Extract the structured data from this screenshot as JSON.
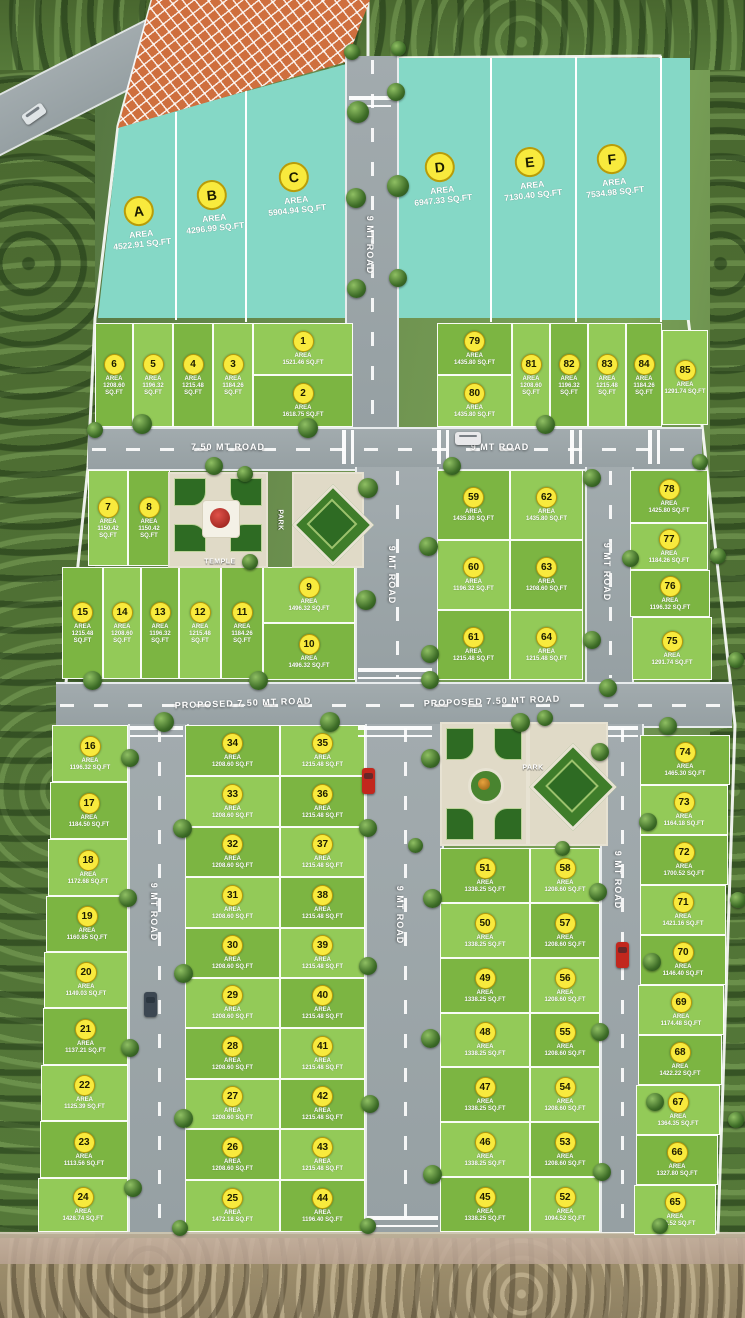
{
  "site": {
    "name": "residential-plot-layout",
    "colors": {
      "teal_plot": "#85d8c6",
      "plot_green_dark": "#7cb542",
      "plot_green_light": "#93ca58",
      "road_gray": "#9aa4a7",
      "marker_yellow": "#f8ea3d",
      "hatch_orange": "#cf6f3e",
      "boundary_white": "#ffffff"
    }
  },
  "teal_plots": [
    {
      "id": "A",
      "area_label": "AREA",
      "sqft": "4522.91 SQ.FT",
      "cx": 140,
      "cy": 212
    },
    {
      "id": "B",
      "area_label": "AREA",
      "sqft": "4296.99 SQ.FT",
      "cx": 213,
      "cy": 196
    },
    {
      "id": "C",
      "area_label": "AREA",
      "sqft": "5904.94 SQ.FT",
      "cx": 295,
      "cy": 178
    },
    {
      "id": "D",
      "area_label": "AREA",
      "sqft": "6947.33 SQ.FT",
      "cx": 441,
      "cy": 168
    },
    {
      "id": "E",
      "area_label": "AREA",
      "sqft": "7130.40 SQ.FT",
      "cx": 531,
      "cy": 163
    },
    {
      "id": "F",
      "area_label": "AREA",
      "sqft": "7534.98 SQ.FT",
      "cx": 613,
      "cy": 160
    }
  ],
  "plots": [
    [
      6,
      95,
      323,
      38,
      104,
      0,
      "1208.60 SQ.FT"
    ],
    [
      5,
      133,
      323,
      40,
      104,
      1,
      "1196.32 SQ.FT"
    ],
    [
      4,
      173,
      323,
      40,
      104,
      0,
      "1215.48 SQ.FT"
    ],
    [
      3,
      213,
      323,
      40,
      104,
      1,
      "1184.26 SQ.FT"
    ],
    [
      1,
      253,
      323,
      100,
      52,
      1,
      "1521.46 SQ.FT"
    ],
    [
      2,
      253,
      375,
      100,
      52,
      0,
      "1618.75 SQ.FT"
    ],
    [
      79,
      437,
      323,
      75,
      52,
      0,
      "1435.80 SQ.FT"
    ],
    [
      80,
      437,
      375,
      75,
      52,
      1,
      "1435.80 SQ.FT"
    ],
    [
      81,
      512,
      323,
      38,
      104,
      1,
      "1208.60 SQ.FT"
    ],
    [
      82,
      550,
      323,
      38,
      104,
      0,
      "1196.32 SQ.FT"
    ],
    [
      83,
      588,
      323,
      38,
      104,
      1,
      "1215.48 SQ.FT"
    ],
    [
      84,
      626,
      323,
      36,
      104,
      0,
      "1184.26 SQ.FT"
    ],
    [
      85,
      662,
      330,
      46,
      95,
      1,
      "1291.74 SQ.FT"
    ],
    [
      7,
      88,
      470,
      40,
      96,
      1,
      "1150.42 SQ.FT"
    ],
    [
      8,
      128,
      470,
      42,
      96,
      0,
      "1150.42 SQ.FT"
    ],
    [
      15,
      62,
      567,
      41,
      112,
      0,
      "1215.48 SQ.FT"
    ],
    [
      14,
      103,
      567,
      38,
      112,
      1,
      "1208.60 SQ.FT"
    ],
    [
      13,
      141,
      567,
      38,
      112,
      0,
      "1196.32 SQ.FT"
    ],
    [
      12,
      179,
      567,
      42,
      112,
      1,
      "1215.48 SQ.FT"
    ],
    [
      11,
      221,
      567,
      42,
      112,
      0,
      "1184.26 SQ.FT"
    ],
    [
      9,
      263,
      567,
      92,
      56,
      1,
      "1496.32 SQ.FT"
    ],
    [
      10,
      263,
      623,
      92,
      57,
      0,
      "1496.32 SQ.FT"
    ],
    [
      59,
      437,
      470,
      73,
      70,
      0,
      "1435.80 SQ.FT"
    ],
    [
      60,
      437,
      540,
      73,
      70,
      1,
      "1196.32 SQ.FT"
    ],
    [
      61,
      437,
      610,
      73,
      70,
      0,
      "1215.48 SQ.FT"
    ],
    [
      62,
      510,
      470,
      73,
      70,
      1,
      "1435.80 SQ.FT"
    ],
    [
      63,
      510,
      540,
      73,
      70,
      0,
      "1208.60 SQ.FT"
    ],
    [
      64,
      510,
      610,
      73,
      70,
      1,
      "1215.48 SQ.FT"
    ],
    [
      78,
      630,
      470,
      78,
      53,
      0,
      "1425.80 SQ.FT"
    ],
    [
      77,
      630,
      523,
      78,
      47,
      1,
      "1184.26 SQ.FT"
    ],
    [
      76,
      630,
      570,
      80,
      47,
      0,
      "1196.32 SQ.FT"
    ],
    [
      75,
      632,
      617,
      80,
      63,
      1,
      "1291.74 SQ.FT"
    ],
    [
      16,
      52,
      725,
      76,
      57,
      1,
      "1196.32 SQ.FT"
    ],
    [
      17,
      50,
      782,
      78,
      57,
      0,
      "1184.50 SQ.FT"
    ],
    [
      18,
      48,
      839,
      80,
      57,
      1,
      "1172.68 SQ.FT"
    ],
    [
      19,
      46,
      896,
      82,
      56,
      0,
      "1160.85 SQ.FT"
    ],
    [
      20,
      44,
      952,
      84,
      56,
      1,
      "1149.03 SQ.FT"
    ],
    [
      21,
      43,
      1008,
      85,
      57,
      0,
      "1137.21 SQ.FT"
    ],
    [
      22,
      41,
      1065,
      87,
      56,
      1,
      "1125.39 SQ.FT"
    ],
    [
      23,
      40,
      1121,
      88,
      57,
      0,
      "1113.56 SQ.FT"
    ],
    [
      24,
      38,
      1178,
      90,
      54,
      1,
      "1428.74 SQ.FT"
    ],
    [
      34,
      185,
      725,
      95,
      51,
      0,
      "1208.60 SQ.FT"
    ],
    [
      33,
      185,
      776,
      95,
      51,
      1,
      "1208.60 SQ.FT"
    ],
    [
      32,
      185,
      827,
      95,
      50,
      0,
      "1208.60 SQ.FT"
    ],
    [
      31,
      185,
      877,
      95,
      51,
      1,
      "1208.60 SQ.FT"
    ],
    [
      30,
      185,
      928,
      95,
      50,
      0,
      "1208.60 SQ.FT"
    ],
    [
      29,
      185,
      978,
      95,
      50,
      1,
      "1208.60 SQ.FT"
    ],
    [
      28,
      185,
      1028,
      95,
      51,
      0,
      "1208.60 SQ.FT"
    ],
    [
      27,
      185,
      1079,
      95,
      50,
      1,
      "1208.60 SQ.FT"
    ],
    [
      26,
      185,
      1129,
      95,
      51,
      0,
      "1208.60 SQ.FT"
    ],
    [
      25,
      185,
      1180,
      95,
      52,
      1,
      "1472.18 SQ.FT"
    ],
    [
      35,
      280,
      725,
      85,
      51,
      1,
      "1215.48 SQ.FT"
    ],
    [
      36,
      280,
      776,
      85,
      51,
      0,
      "1215.48 SQ.FT"
    ],
    [
      37,
      280,
      827,
      85,
      50,
      1,
      "1215.48 SQ.FT"
    ],
    [
      38,
      280,
      877,
      85,
      51,
      0,
      "1215.48 SQ.FT"
    ],
    [
      39,
      280,
      928,
      85,
      50,
      1,
      "1215.48 SQ.FT"
    ],
    [
      40,
      280,
      978,
      85,
      50,
      0,
      "1215.48 SQ.FT"
    ],
    [
      41,
      280,
      1028,
      85,
      51,
      1,
      "1215.48 SQ.FT"
    ],
    [
      42,
      280,
      1079,
      85,
      50,
      0,
      "1215.48 SQ.FT"
    ],
    [
      43,
      280,
      1129,
      85,
      51,
      1,
      "1215.48 SQ.FT"
    ],
    [
      44,
      280,
      1180,
      85,
      52,
      0,
      "1196.40 SQ.FT"
    ],
    [
      51,
      440,
      848,
      90,
      55,
      0,
      "1338.25 SQ.FT"
    ],
    [
      50,
      440,
      903,
      90,
      55,
      1,
      "1338.25 SQ.FT"
    ],
    [
      49,
      440,
      958,
      90,
      55,
      0,
      "1338.25 SQ.FT"
    ],
    [
      48,
      440,
      1013,
      90,
      54,
      1,
      "1338.25 SQ.FT"
    ],
    [
      47,
      440,
      1067,
      90,
      55,
      0,
      "1338.25 SQ.FT"
    ],
    [
      46,
      440,
      1122,
      90,
      55,
      1,
      "1338.25 SQ.FT"
    ],
    [
      45,
      440,
      1177,
      90,
      55,
      0,
      "1338.25 SQ.FT"
    ],
    [
      58,
      530,
      848,
      70,
      55,
      1,
      "1208.60 SQ.FT"
    ],
    [
      57,
      530,
      903,
      70,
      55,
      0,
      "1208.60 SQ.FT"
    ],
    [
      56,
      530,
      958,
      70,
      55,
      1,
      "1208.60 SQ.FT"
    ],
    [
      55,
      530,
      1013,
      70,
      54,
      0,
      "1208.60 SQ.FT"
    ],
    [
      54,
      530,
      1067,
      70,
      55,
      1,
      "1208.60 SQ.FT"
    ],
    [
      53,
      530,
      1122,
      70,
      55,
      0,
      "1208.60 SQ.FT"
    ],
    [
      52,
      530,
      1177,
      70,
      55,
      1,
      "1094.52 SQ.FT"
    ],
    [
      74,
      640,
      735,
      90,
      50,
      0,
      "1465.30 SQ.FT"
    ],
    [
      73,
      640,
      785,
      88,
      50,
      1,
      "1164.18 SQ.FT"
    ],
    [
      72,
      640,
      835,
      88,
      50,
      0,
      "1700.52 SQ.FT"
    ],
    [
      71,
      640,
      885,
      86,
      50,
      1,
      "1421.16 SQ.FT"
    ],
    [
      70,
      640,
      935,
      86,
      50,
      0,
      "1146.40 SQ.FT"
    ],
    [
      69,
      638,
      985,
      86,
      50,
      1,
      "1174.48 SQ.FT"
    ],
    [
      68,
      638,
      1035,
      84,
      50,
      0,
      "1422.22 SQ.FT"
    ],
    [
      67,
      636,
      1085,
      84,
      50,
      1,
      "1364.35 SQ.FT"
    ],
    [
      66,
      636,
      1135,
      82,
      50,
      0,
      "1327.80 SQ.FT"
    ],
    [
      65,
      634,
      1185,
      82,
      50,
      1,
      "1312.52 SQ.FT"
    ]
  ],
  "roads": [
    {
      "id": "top-vertical",
      "label": "9 MT ROAD",
      "dir": "v",
      "x": 345,
      "y": 56,
      "w": 50,
      "h": 371,
      "lx": 370,
      "ly": 245
    },
    {
      "id": "upper-horizontal-west",
      "label": "7.50 MT ROAD",
      "dir": "h",
      "x": 88,
      "y": 427,
      "w": 614,
      "h": 40,
      "lx": 228,
      "ly": 447
    },
    {
      "id": "upper-horizontal-east",
      "label": "9 MT ROAD",
      "dir": "h",
      "x": 0,
      "y": 0,
      "w": 0,
      "h": 0,
      "lx": 500,
      "ly": 447
    },
    {
      "id": "center-vertical-mid",
      "label": "9 MT ROAD",
      "dir": "v",
      "x": 355,
      "y": 467,
      "w": 80,
      "h": 215,
      "lx": 392,
      "ly": 575
    },
    {
      "id": "east-vertical-mid",
      "label": "9 MT ROAD",
      "dir": "v",
      "x": 585,
      "y": 467,
      "w": 45,
      "h": 215,
      "lx": 607,
      "ly": 572
    },
    {
      "id": "proposed-road",
      "label": "PROPOSED 7.50 MT ROAD",
      "dir": "h",
      "x": 56,
      "y": 682,
      "w": 676,
      "h": 42,
      "lx": 243,
      "ly": 703
    },
    {
      "id": "proposed-road-east-label",
      "label": "PROPOSED 7.50 MT ROAD",
      "dir": "h",
      "x": 0,
      "y": 0,
      "w": 0,
      "h": 0,
      "lx": 492,
      "ly": 701
    },
    {
      "id": "west-vertical-low",
      "label": "9 MT ROAD",
      "dir": "v",
      "x": 128,
      "y": 724,
      "w": 57,
      "h": 508,
      "lx": 154,
      "ly": 912
    },
    {
      "id": "center-vertical-low",
      "label": "9 MT ROAD",
      "dir": "v",
      "x": 365,
      "y": 724,
      "w": 75,
      "h": 508,
      "lx": 400,
      "ly": 915
    },
    {
      "id": "east-vertical-low",
      "label": "9 MT ROAD",
      "dir": "v",
      "x": 600,
      "y": 724,
      "w": 40,
      "h": 508,
      "lx": 618,
      "ly": 880
    }
  ],
  "crossings": [
    {
      "t": "v",
      "x": 349,
      "y": 96,
      "w": 42,
      "h": 11
    },
    {
      "t": "h",
      "x": 342,
      "y": 430,
      "w": 12,
      "h": 34
    },
    {
      "t": "h",
      "x": 437,
      "y": 430,
      "w": 12,
      "h": 34
    },
    {
      "t": "h",
      "x": 570,
      "y": 430,
      "w": 12,
      "h": 34
    },
    {
      "t": "h",
      "x": 648,
      "y": 430,
      "w": 12,
      "h": 34
    },
    {
      "t": "v",
      "x": 358,
      "y": 668,
      "w": 74,
      "h": 11
    },
    {
      "t": "v",
      "x": 358,
      "y": 726,
      "w": 74,
      "h": 11
    },
    {
      "t": "v",
      "x": 130,
      "y": 726,
      "w": 53,
      "h": 11
    },
    {
      "t": "v",
      "x": 602,
      "y": 726,
      "w": 36,
      "h": 11
    },
    {
      "t": "v",
      "x": 367,
      "y": 1216,
      "w": 71,
      "h": 11
    }
  ],
  "landmarks": {
    "temple": {
      "label": "TEMPLE",
      "x": 168,
      "y": 472,
      "w": 100,
      "h": 96
    },
    "upper_park": {
      "label": "PARK",
      "x": 292,
      "y": 472,
      "w": 72,
      "h": 96,
      "label_x": 280,
      "label_y": 520
    },
    "lower_park_square": {
      "x": 440,
      "y": 722,
      "w": 88,
      "h": 124
    },
    "lower_park_diamond": {
      "label": "PARK",
      "x": 528,
      "y": 722,
      "w": 80,
      "h": 124,
      "label_x": 533,
      "label_y": 768
    },
    "gate_structure": {
      "x": 346,
      "y": 70,
      "w": 48,
      "h": 34
    }
  },
  "trees": [
    [
      358,
      112,
      22
    ],
    [
      396,
      92,
      18
    ],
    [
      356,
      198,
      20
    ],
    [
      398,
      186,
      22
    ],
    [
      356,
      288,
      19
    ],
    [
      398,
      278,
      18
    ],
    [
      352,
      52,
      16
    ],
    [
      398,
      48,
      15
    ],
    [
      142,
      424,
      20
    ],
    [
      214,
      466,
      18
    ],
    [
      308,
      428,
      20
    ],
    [
      452,
      466,
      18
    ],
    [
      545,
      424,
      19
    ],
    [
      95,
      430,
      16
    ],
    [
      368,
      488,
      20
    ],
    [
      428,
      546,
      19
    ],
    [
      366,
      600,
      20
    ],
    [
      430,
      654,
      18
    ],
    [
      245,
      474,
      16
    ],
    [
      250,
      562,
      16
    ],
    [
      592,
      478,
      18
    ],
    [
      630,
      558,
      17
    ],
    [
      592,
      640,
      18
    ],
    [
      700,
      462,
      16
    ],
    [
      718,
      556,
      16
    ],
    [
      92,
      680,
      19
    ],
    [
      164,
      722,
      20
    ],
    [
      258,
      680,
      19
    ],
    [
      330,
      722,
      20
    ],
    [
      430,
      680,
      18
    ],
    [
      520,
      722,
      19
    ],
    [
      608,
      688,
      18
    ],
    [
      668,
      726,
      18
    ],
    [
      130,
      758,
      18
    ],
    [
      182,
      828,
      19
    ],
    [
      128,
      898,
      18
    ],
    [
      183,
      973,
      19
    ],
    [
      130,
      1048,
      18
    ],
    [
      183,
      1118,
      19
    ],
    [
      133,
      1188,
      18
    ],
    [
      180,
      1228,
      16
    ],
    [
      430,
      758,
      19
    ],
    [
      368,
      828,
      18
    ],
    [
      432,
      898,
      19
    ],
    [
      368,
      966,
      18
    ],
    [
      430,
      1038,
      19
    ],
    [
      370,
      1104,
      18
    ],
    [
      432,
      1174,
      19
    ],
    [
      368,
      1226,
      16
    ],
    [
      600,
      752,
      18
    ],
    [
      648,
      822,
      18
    ],
    [
      598,
      892,
      18
    ],
    [
      652,
      962,
      18
    ],
    [
      600,
      1032,
      18
    ],
    [
      655,
      1102,
      18
    ],
    [
      602,
      1172,
      18
    ],
    [
      660,
      1226,
      16
    ],
    [
      545,
      718,
      16
    ],
    [
      415,
      845,
      15
    ],
    [
      562,
      848,
      15
    ],
    [
      736,
      660,
      16
    ],
    [
      738,
      900,
      16
    ],
    [
      736,
      1120,
      16
    ]
  ],
  "cars": [
    {
      "x": 455,
      "y": 432,
      "w": 26,
      "h": 13,
      "color": "#e8e8ea",
      "rot": 0,
      "name": "white-truck"
    },
    {
      "x": 362,
      "y": 768,
      "w": 13,
      "h": 26,
      "color": "#c2271d",
      "rot": 0,
      "name": "red-car-center-road"
    },
    {
      "x": 616,
      "y": 942,
      "w": 13,
      "h": 26,
      "color": "#c2271d",
      "rot": 0,
      "name": "red-car-east-road"
    },
    {
      "x": 144,
      "y": 992,
      "w": 13,
      "h": 25,
      "color": "#3c4752",
      "rot": 0,
      "name": "dark-car-west-road"
    },
    {
      "x": 22,
      "y": 108,
      "w": 24,
      "h": 12,
      "color": "#dfe4e6",
      "rot": -35,
      "name": "white-car-outer-road"
    }
  ],
  "area_word": "AREA"
}
